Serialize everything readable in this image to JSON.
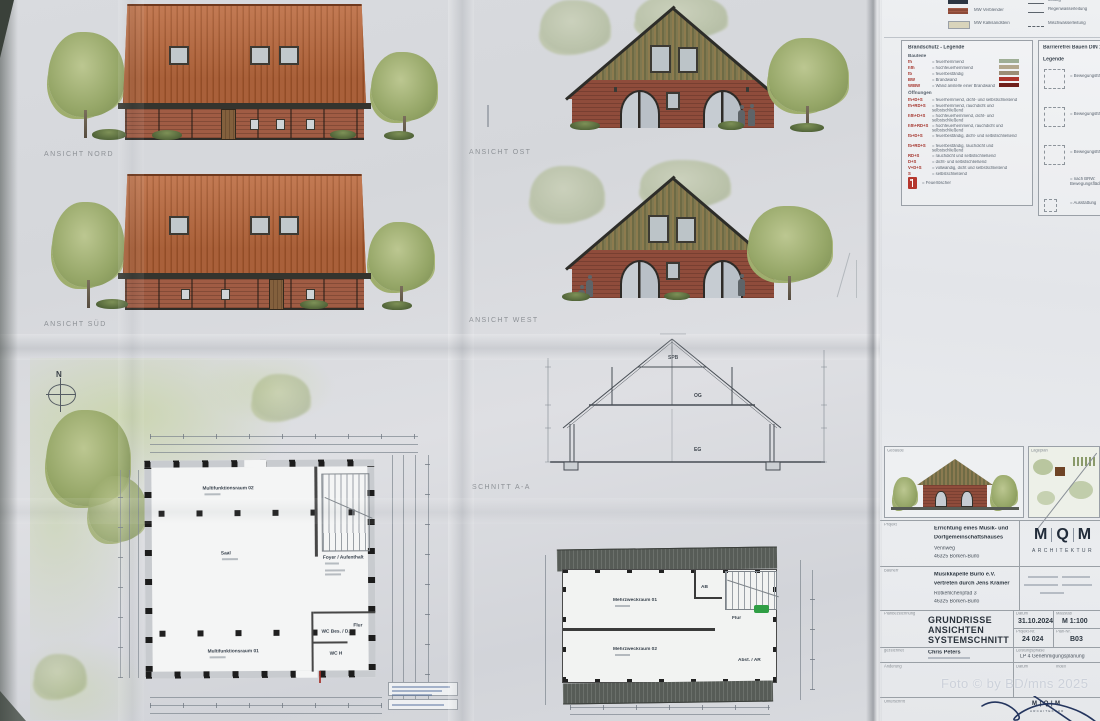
{
  "photo_credit": "Foto © by BD/mns 2025",
  "labels": {
    "ansicht_nord": "ANSICHT NORD",
    "ansicht_sued": "ANSICHT SÜD",
    "ansicht_ost": "ANSICHT OST",
    "ansicht_west": "ANSICHT WEST",
    "schnitt": "SCHNITT A-A",
    "north": "N"
  },
  "section_levels": {
    "spb": "SPB",
    "og": "OG",
    "eg": "EG"
  },
  "plan_eg": {
    "rooms": {
      "mfr02": "Multifunktionsraum 02",
      "saal": "Saal",
      "foyer": "Foyer / Aufenthalt",
      "flur": "Flur",
      "wc_bes": "WC Bes. / D.",
      "wc_h": "WC H",
      "mfr01": "Multifunktionsraum 01"
    }
  },
  "plan_og": {
    "rooms": {
      "mzr01": "Mehrzweckraum 01",
      "mzr02": "Mehrzweckraum 02",
      "ab": "AB",
      "flur": "Flur",
      "abst": "Abst. / AR"
    }
  },
  "material_legend": {
    "row2": "MW Verblender",
    "row3": "MW Kalksandstein",
    "pipe1": "leitung",
    "pipe2": "Regenwasserleitung",
    "pipe3": "Mischwasserleitung"
  },
  "fire_legend": {
    "title": "Brandschutz - Legende",
    "group1_title": "Bauteile",
    "group1": [
      {
        "code": "fh",
        "text": "= feuerhemmend"
      },
      {
        "code": "hfh",
        "text": "= hochfeuerhemmend"
      },
      {
        "code": "fb",
        "text": "= feuerbeständig"
      },
      {
        "code": "BW",
        "text": "= Brandwand"
      },
      {
        "code": "W/BW",
        "text": "= Wand anstelle einer Brandwand"
      }
    ],
    "group2_title": "Öffnungen",
    "group2": [
      {
        "code": "fh+D+S",
        "text": "= feuerhemmend, dicht- und selbstschließend"
      },
      {
        "code": "fh+RD+S",
        "text": "= feuerhemmend, rauchdicht und selbstschließend"
      },
      {
        "code": "hfh+D+S",
        "text": "= hochfeuerhemmend, dicht- und selbstschließend"
      },
      {
        "code": "hfh+RD+S",
        "text": "= hochfeuerhemmend, rauchdicht und selbstschließend"
      },
      {
        "code": "fb+D+S",
        "text": "= feuerbeständig, dicht- und selbstschließend"
      },
      {
        "code": "fb+RD+S",
        "text": "= feuerbeständig, rauchdicht und selbstschließend"
      },
      {
        "code": "RD+S",
        "text": "= rauchdicht und selbstschließend"
      },
      {
        "code": "D+S",
        "text": "= dicht- und selbstschließend"
      },
      {
        "code": "V+D+S",
        "text": "= vollwandig, dicht und selbstschließend"
      },
      {
        "code": "S",
        "text": "= selbstschließend"
      }
    ],
    "extinguisher_text": "= Feuerlöscher"
  },
  "accessibility_legend": {
    "title": "Barrierefrei Bauen DIN 18040-2",
    "subtitle": "Legende",
    "items": [
      "= Bewegungsfläche",
      "= Bewegungsfläche",
      "= Bewegungsfläche",
      "= nach BRW: Bewegungsflächen",
      "= Ausstattung"
    ]
  },
  "title_block": {
    "preview_building_label": "Gebäude",
    "preview_siteplan_label": "Lageplan",
    "project_label": "Projekt",
    "project_line1": "Errichtung eines Musik- und",
    "project_line2": "Dorfgemeinschaftshauses",
    "project_line3": "Vennweg",
    "project_line4": "46325 Borken-Burlo",
    "client_label": "Bauherr",
    "client_line1": "Musikkapelle Burlo e.V.",
    "client_line2": "vertreten durch Jens Krämer",
    "client_line3": "Rotkehlchenpfad 3",
    "client_line4": "46325 Borken-Burlo",
    "logo_m1": "M",
    "logo_q": "Q",
    "logo_m2": "M",
    "logo_sub": "ARCHITEKTUR",
    "plan_label": "Planbezeichnung",
    "plan_line1": "GRUNDRISSE",
    "plan_line2": "ANSICHTEN",
    "plan_line3": "SYSTEMSCHNITT",
    "date_label": "Datum",
    "date": "31.10.2024",
    "scale_label": "Maßstab",
    "scale": "M 1:100",
    "project_no_label": "Projekt-Nr.",
    "project_no": "24 024",
    "plan_no_label": "Plan-Nr.",
    "plan_no": "B03",
    "drawn_label": "gezeichnet",
    "drawn": "Chris Peters",
    "phase_label": "Leistungsphase",
    "phase": "LP 4 Genehmigungsplanung",
    "change_label": "Änderung",
    "change_date_label": "Datum",
    "index_label": "Index",
    "sign_label": "Unterschrift"
  }
}
